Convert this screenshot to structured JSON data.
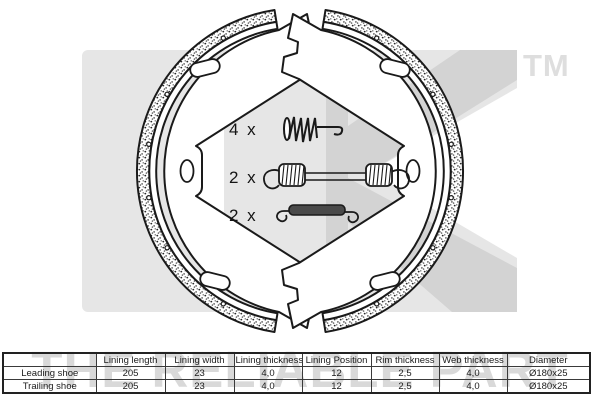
{
  "brand": {
    "trademark": "TM",
    "slogan": "THE RELIABLE PART",
    "logo_name": "nk-logo-watermark"
  },
  "diagram": {
    "type": "brake-shoe-kit-technical-drawing",
    "parts": [
      "leading-brake-shoe",
      "trailing-brake-shoe",
      "hold-down-pin-spring",
      "long-return-spring",
      "short-return-spring"
    ],
    "labels": {
      "item1_qty": "4 x",
      "item2_qty": "2 x",
      "item3_qty": "2 x"
    }
  },
  "spec_table": {
    "headers": [
      "",
      "Lining length",
      "Lining width",
      "Lining thickness",
      "Lining Position",
      "Rim thickness",
      "Web thickness",
      "Diameter"
    ],
    "rows": [
      {
        "label": "Leading shoe",
        "values": [
          "205",
          "23",
          "4,0",
          "12",
          "2,5",
          "4,0",
          "Ø180x25"
        ]
      },
      {
        "label": "Trailing shoe",
        "values": [
          "205",
          "23",
          "4,0",
          "12",
          "2,5",
          "4,0",
          "Ø180x25"
        ]
      }
    ]
  },
  "colors": {
    "line": "#1a1a1a",
    "watermark_square": "#e6e6e6",
    "watermark_letters": "#d3d3d3",
    "watermark_text": "#d9d9d9"
  }
}
